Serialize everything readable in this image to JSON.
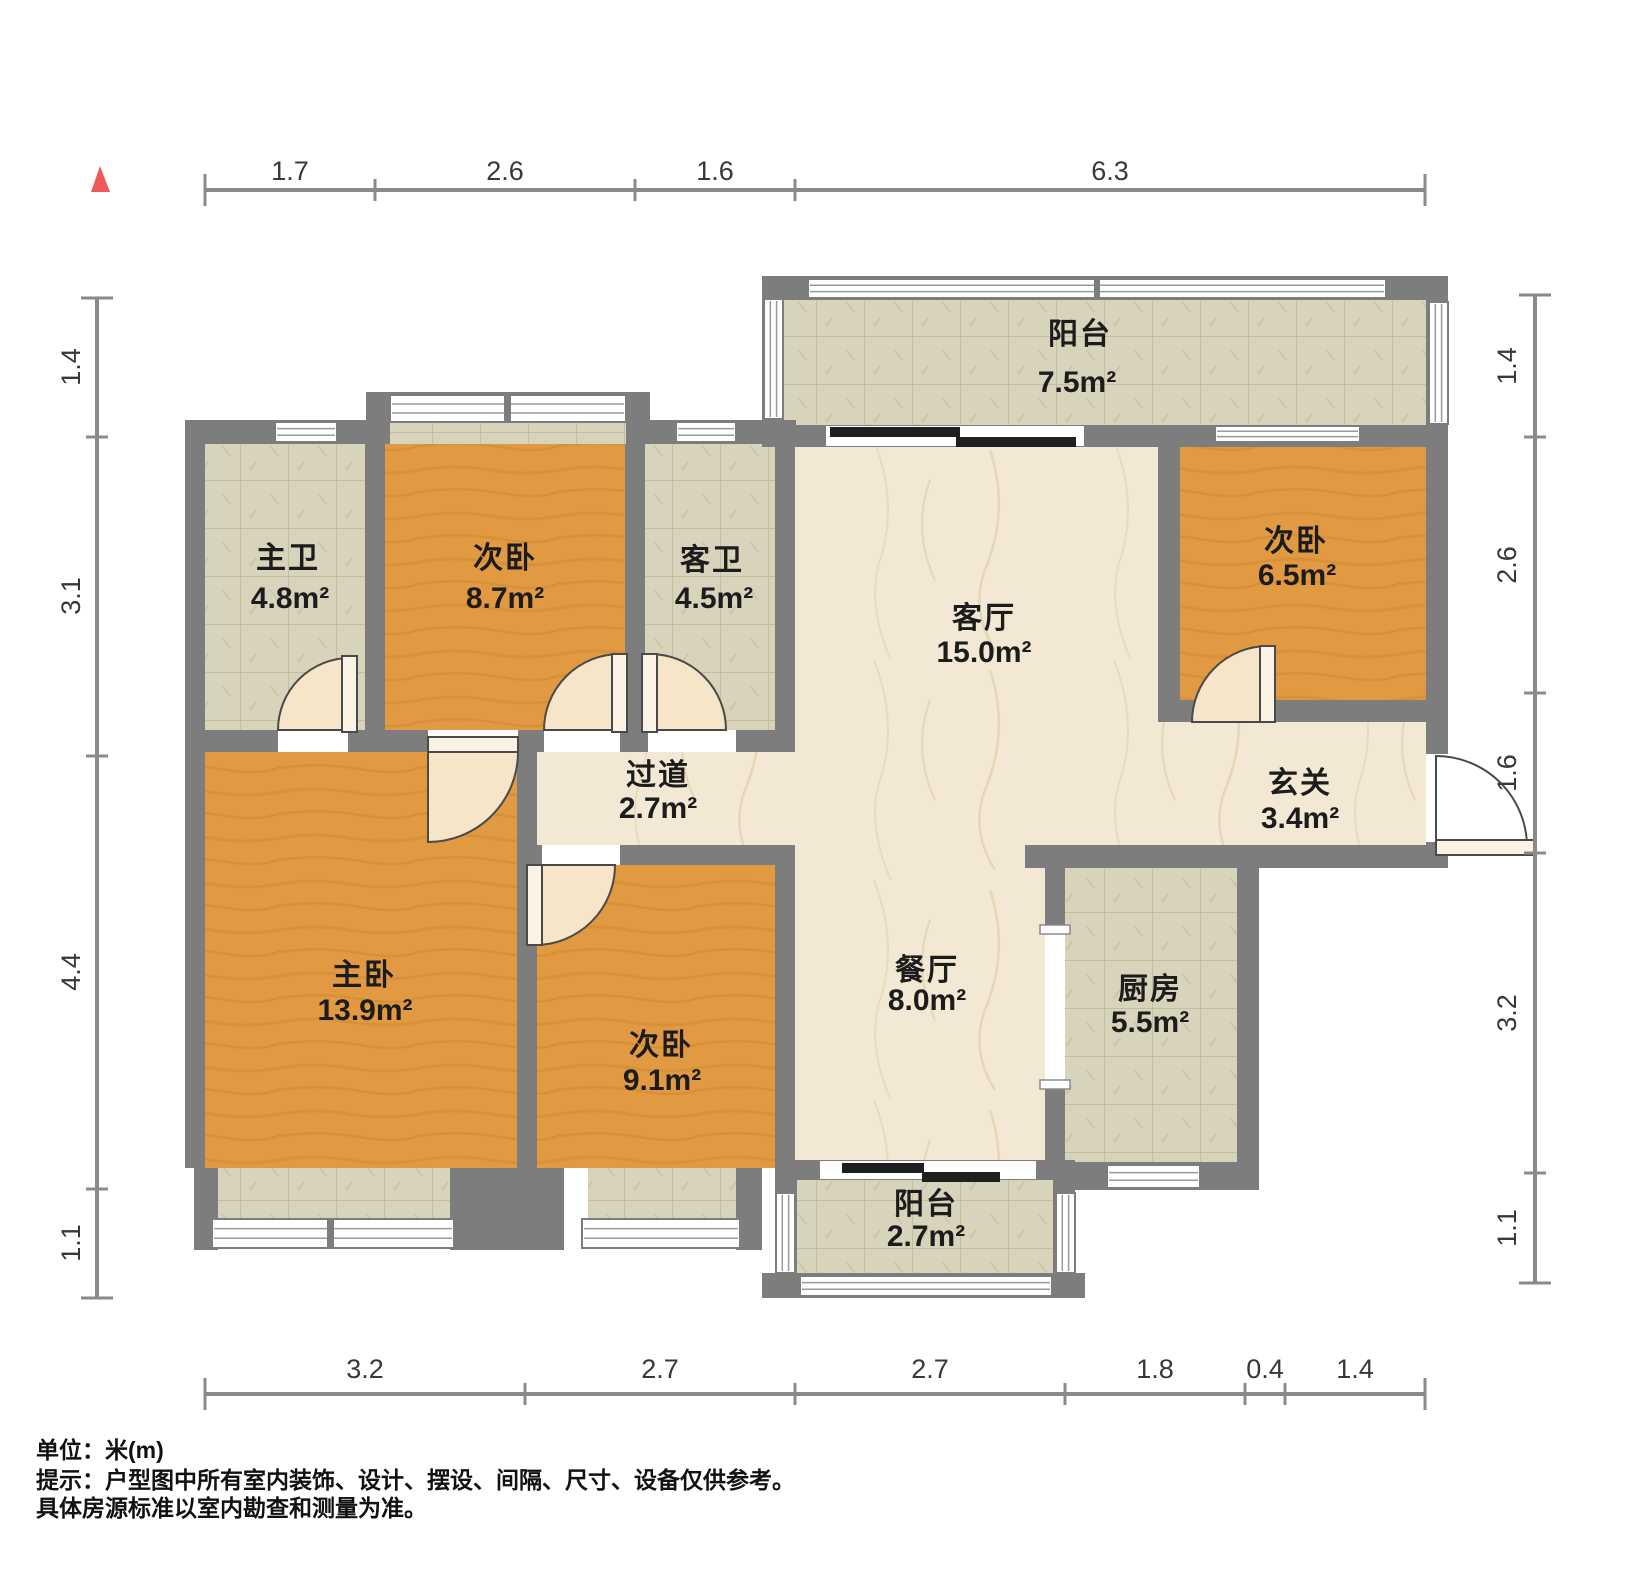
{
  "rooms": {
    "balcony_top": {
      "name": "阳台",
      "area": "7.5m²"
    },
    "bath_master": {
      "name": "主卫",
      "area": "4.8m²"
    },
    "bed_top": {
      "name": "次卧",
      "area": "8.7m²"
    },
    "bath_guest": {
      "name": "客卫",
      "area": "4.5m²"
    },
    "living": {
      "name": "客厅",
      "area": "15.0m²"
    },
    "bed_right": {
      "name": "次卧",
      "area": "6.5m²"
    },
    "hallway": {
      "name": "过道",
      "area": "2.7m²"
    },
    "foyer": {
      "name": "玄关",
      "area": "3.4m²"
    },
    "bed_master": {
      "name": "主卧",
      "area": "13.9m²"
    },
    "bed_mid": {
      "name": "次卧",
      "area": "9.1m²"
    },
    "dining": {
      "name": "餐厅",
      "area": "8.0m²"
    },
    "kitchen": {
      "name": "厨房",
      "area": "5.5m²"
    },
    "balcony_bottom": {
      "name": "阳台",
      "area": "2.7m²"
    }
  },
  "dims": {
    "top": [
      "1.7",
      "2.6",
      "1.6",
      "6.3"
    ],
    "left": [
      "1.4",
      "3.1",
      "4.4",
      "1.1"
    ],
    "right": [
      "1.4",
      "2.6",
      "1.6",
      "3.2",
      "1.1"
    ],
    "bottom": [
      "3.2",
      "2.7",
      "2.7",
      "1.8",
      "0.4",
      "1.4"
    ]
  },
  "footer": {
    "line1": "单位：米(m)",
    "line2": "提示：户型图中所有室内装饰、设计、摆设、间隔、尺寸、设备仅供参考。",
    "line3": "具体房源标准以室内勘查和测量为准。"
  },
  "colors": {
    "wall": "#7D7D7D",
    "wood_floor": "#E19A41",
    "tile_floor": "#D8D3BB",
    "marble_floor": "#F3E8D3",
    "north_marker": "#F0595B",
    "sliding_door": "#1F1F1F"
  }
}
